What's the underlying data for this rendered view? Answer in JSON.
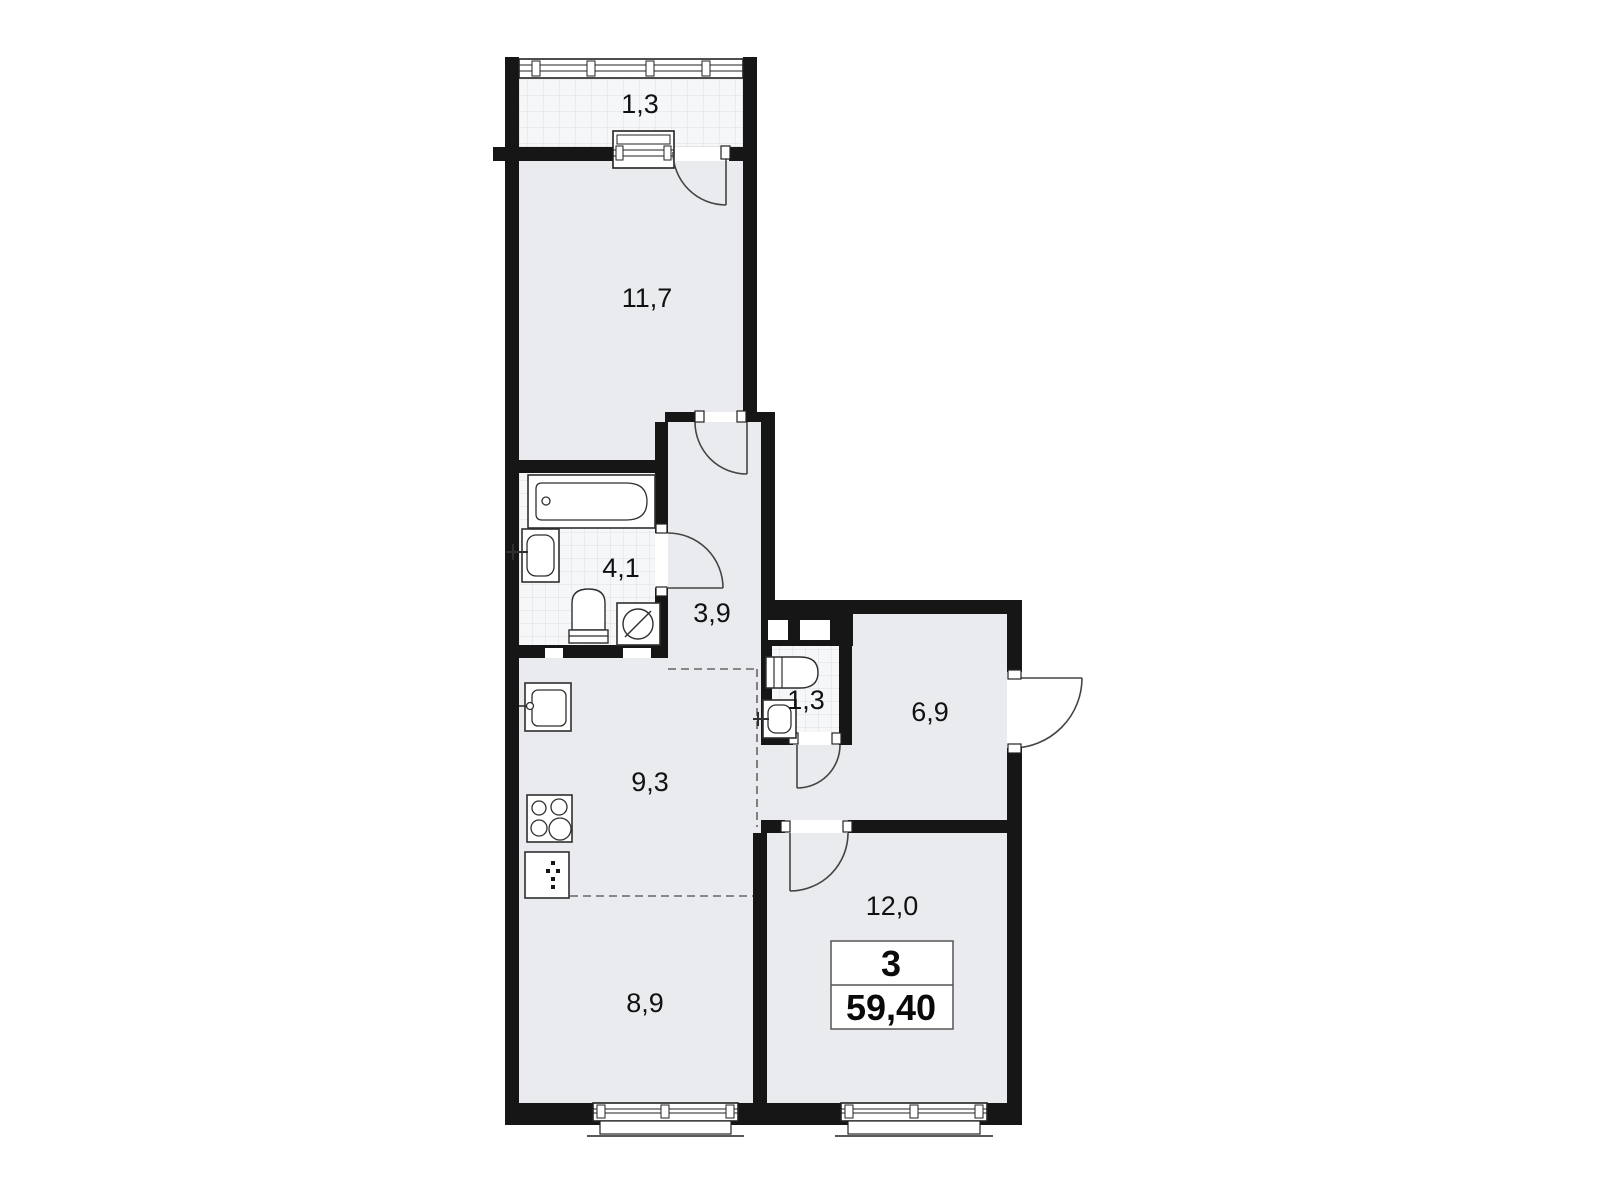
{
  "plan": {
    "type": "apartment-floor-plan",
    "summary": {
      "rooms_count": "3",
      "total_area": "59,40"
    },
    "rooms": [
      {
        "id": "balcony",
        "label": "1,3"
      },
      {
        "id": "bedroom",
        "label": "11,7"
      },
      {
        "id": "bathroom",
        "label": "4,1"
      },
      {
        "id": "hallway",
        "label": "3,9"
      },
      {
        "id": "wc",
        "label": "1,3"
      },
      {
        "id": "entry",
        "label": "6,9"
      },
      {
        "id": "kitchen",
        "label": "9,3"
      },
      {
        "id": "living",
        "label": "12,0"
      },
      {
        "id": "room2",
        "label": "8,9"
      }
    ],
    "fixtures": [
      "bathtub",
      "bath-sink",
      "bath-toilet",
      "washing-machine",
      "wc-toilet",
      "wc-sink",
      "kitchen-sink",
      "cooktop",
      "fridge"
    ],
    "colors": {
      "wall": "#161616",
      "room_fill": "#e9ebee",
      "tile_fill": "#f6f7f8",
      "tile_line": "#dcdfe2",
      "fixture_stroke": "#2f2f2f",
      "door_stroke": "#444444",
      "dash_line": "#666666",
      "label": "#111111",
      "background": "#ffffff"
    }
  }
}
